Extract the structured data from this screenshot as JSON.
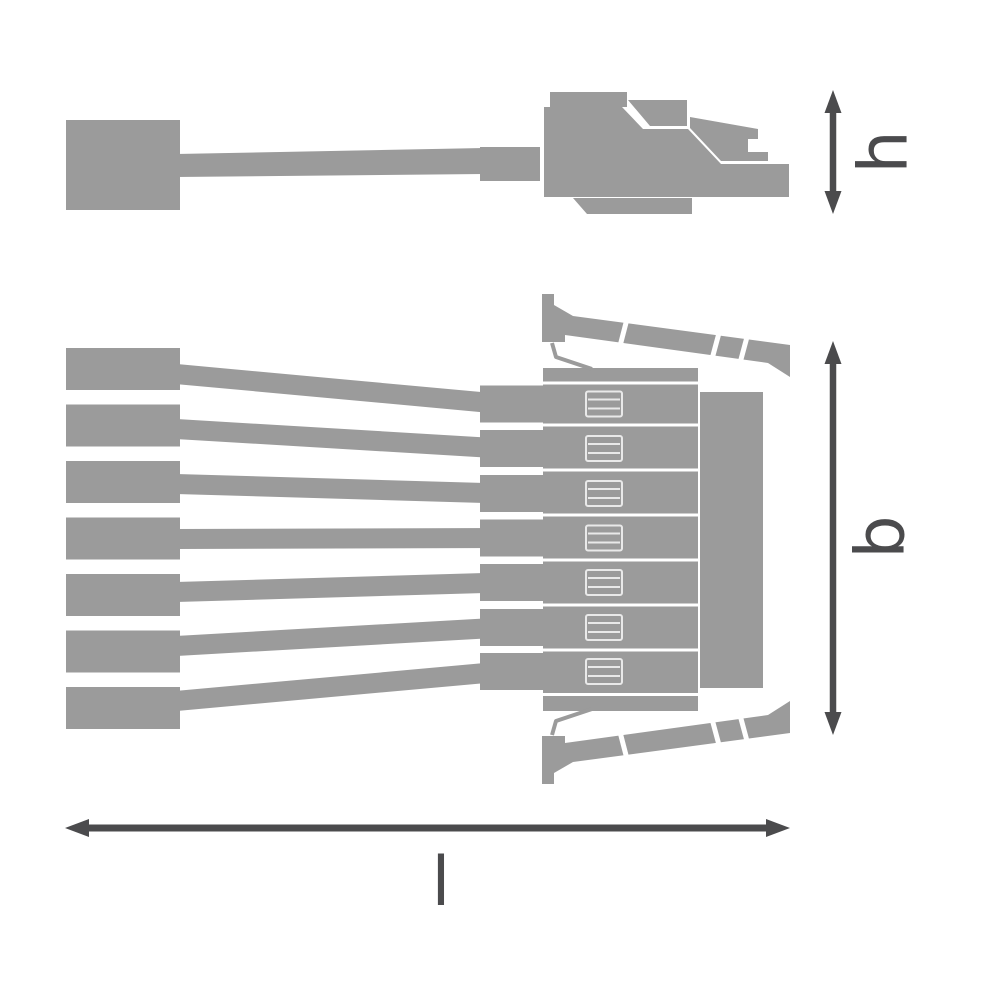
{
  "colors": {
    "part_gray": "#9b9b9b",
    "dimension_color": "#4b4b4d",
    "seam_white": "#ffffff",
    "terminal_detail": "#e9e9e9",
    "background": "#ffffff"
  },
  "dimension_labels": {
    "height": "h",
    "width": "b",
    "length": "l"
  },
  "plan_view": {
    "wire_count": 7,
    "terminal_count": 7
  }
}
